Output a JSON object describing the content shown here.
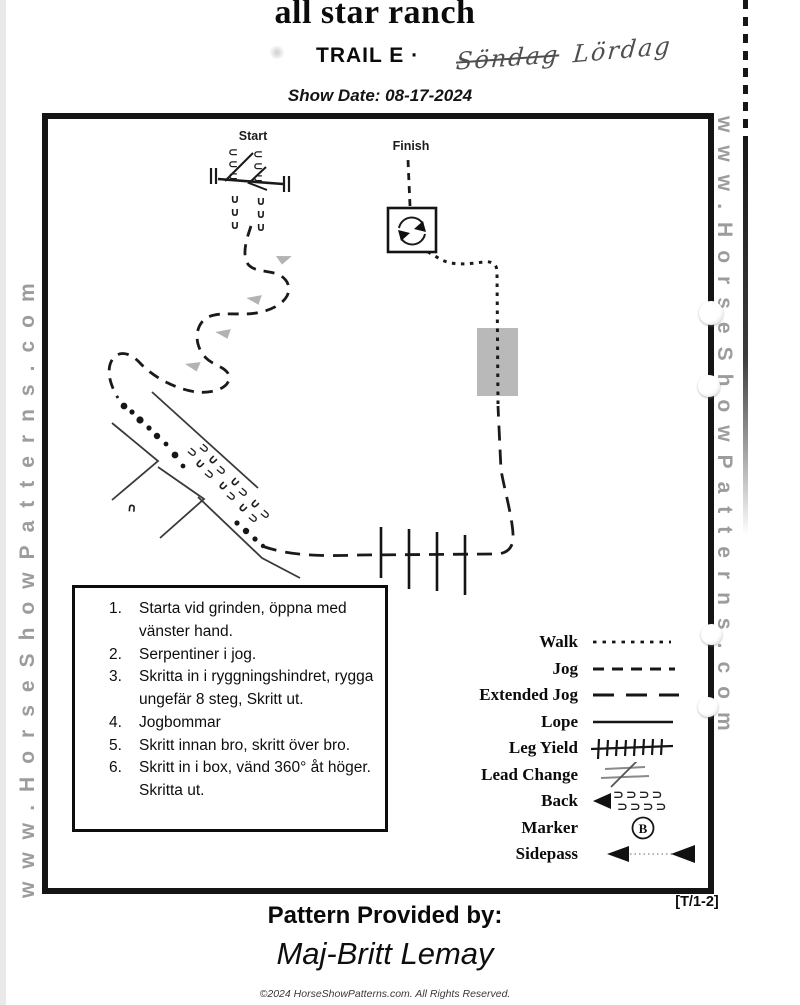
{
  "header": {
    "ranch_title": "all star ranch",
    "trail_title": "TRAIL E ·",
    "handwritten_crossed": "Söndag",
    "handwritten": "Lördag",
    "show_date": "Show Date: 08-17-2024"
  },
  "watermark": {
    "left": "www.HorseShowPatterns.com",
    "right": "www.HorseShowPatterns.com"
  },
  "course": {
    "start_label": "Start",
    "finish_label": "Finish"
  },
  "instructions": {
    "items": [
      {
        "num": "1.",
        "text": "Starta vid grinden, öppna med vänster hand."
      },
      {
        "num": "2.",
        "text": "Serpentiner i jog."
      },
      {
        "num": "3.",
        "text": "Skritta in i ryggningshindret, rygga ungefär 8 steg, Skritt ut."
      },
      {
        "num": "4.",
        "text": "Jogbommar"
      },
      {
        "num": "5.",
        "text": "Skritt innan bro, skritt över bro."
      },
      {
        "num": "6.",
        "text": "Skritt in i box, vänd 360° åt höger. Skritta ut."
      }
    ]
  },
  "legend": {
    "marker_letter": "B",
    "rows": [
      {
        "label": "Walk"
      },
      {
        "label": "Jog"
      },
      {
        "label": "Extended Jog"
      },
      {
        "label": "Lope"
      },
      {
        "label": "Leg Yield"
      },
      {
        "label": "Lead Change"
      },
      {
        "label": "Back"
      },
      {
        "label": "Marker"
      },
      {
        "label": "Sidepass"
      }
    ]
  },
  "footer": {
    "page_ref": "[T/1-2]",
    "provided_by_label": "Pattern Provided by:",
    "provided_by_name": "Maj-Britt Lemay",
    "copyright": "©2024 HorseShowPatterns.com. All Rights Reserved."
  },
  "colors": {
    "ink": "#141414",
    "gray_arrow": "#b3b3b3",
    "bridge_fill": "#b9b9b9",
    "watermark_gray": "#9c9c9c",
    "handwriting": "#4f4f4f"
  }
}
